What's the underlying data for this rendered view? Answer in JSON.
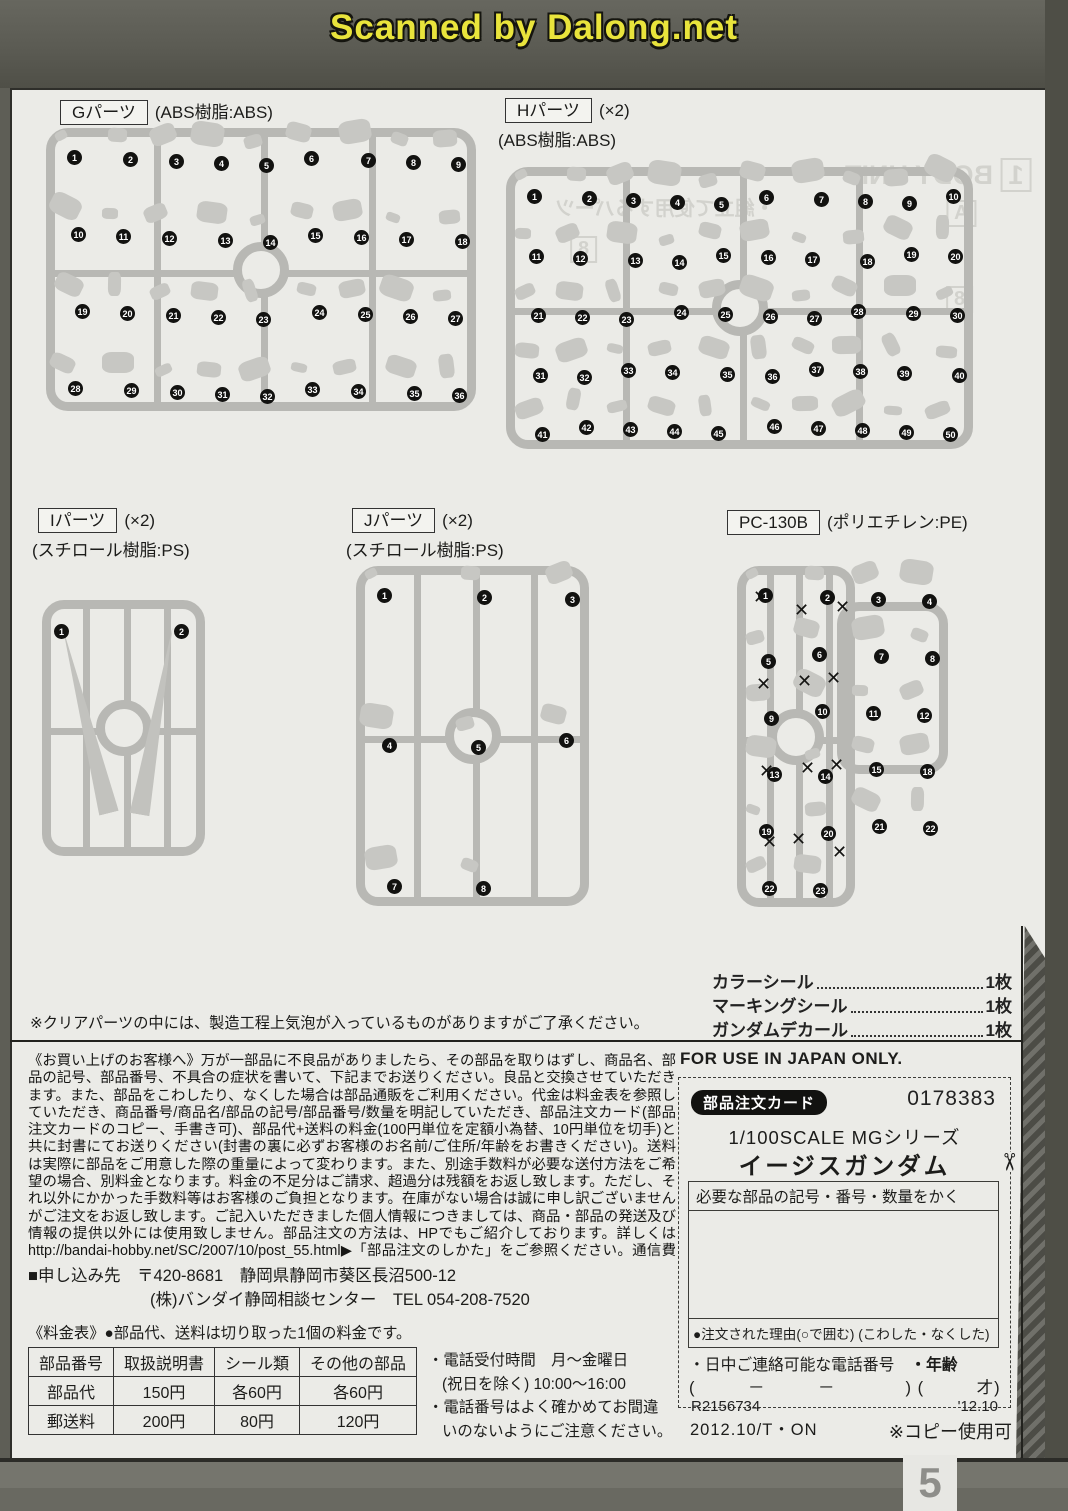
{
  "watermark": "Scanned by Dalong.net",
  "page_number": "5",
  "runners": [
    {
      "id": "G",
      "label": "Gパーツ",
      "qty": "",
      "material": "(ABS樹脂:ABS)",
      "numbers": [
        1,
        2,
        3,
        4,
        5,
        6,
        7,
        8,
        9,
        10,
        11,
        12,
        13,
        14,
        15,
        16,
        17,
        18,
        19,
        20,
        21,
        22,
        23,
        24,
        25,
        26,
        27,
        28,
        29,
        30,
        31,
        32,
        33,
        34,
        35,
        36
      ]
    },
    {
      "id": "H",
      "label": "Hパーツ",
      "qty": "(×2)",
      "material": "(ABS樹脂:ABS)",
      "numbers": [
        1,
        2,
        3,
        4,
        5,
        6,
        7,
        8,
        9,
        10,
        11,
        12,
        13,
        14,
        15,
        16,
        17,
        18,
        19,
        20,
        21,
        22,
        23,
        24,
        25,
        26,
        27,
        28,
        29,
        30,
        31,
        32,
        33,
        34,
        35,
        36,
        37,
        38,
        39,
        40,
        41,
        42,
        43,
        44,
        45,
        46,
        47,
        48,
        49,
        50
      ]
    },
    {
      "id": "I",
      "label": "Iパーツ",
      "qty": "(×2)",
      "material": "(スチロール樹脂:PS)",
      "numbers": [
        1,
        2
      ]
    },
    {
      "id": "J",
      "label": "Jパーツ",
      "qty": "(×2)",
      "material": "(スチロール樹脂:PS)",
      "numbers": [
        1,
        2,
        3,
        4,
        5,
        6,
        7,
        8
      ]
    },
    {
      "id": "PC",
      "label": "PC-130B",
      "qty": "",
      "material": "(ポリエチレン:PE)",
      "numbers": [
        1,
        2,
        3,
        4,
        5,
        6,
        7,
        8,
        9,
        10,
        11,
        12,
        13,
        14,
        15,
        18,
        19,
        20,
        21,
        22,
        22,
        23
      ],
      "x_count": 12
    }
  ],
  "stickers": [
    {
      "name": "カラーシール",
      "count": "1枚"
    },
    {
      "name": "マーキングシール",
      "count": "1枚"
    },
    {
      "name": "ガンダムデカール",
      "count": "1枚"
    }
  ],
  "clear_parts_note": "※クリアパーツの中には、製造工程上気泡が入っているものがありますがご了承ください。",
  "customer_notice": {
    "body": "《お買い上げのお客様へ》万が一部品に不良品がありましたら、その部品を取りはずし、商品名、部品の記号、部品番号、不具合の症状を書いて、下記までお送りください。良品と交換させていただきます。また、部品をこわしたり、なくした場合は部品通販をご利用ください。代金は料金表を参照していただき、商品番号/商品名/部品の記号/部品番号/数量を明記していただき、部品注文カード(部品注文カードのコピー、手書き可)、部品代+送料の料金(100円単位を定額小為替、10円単位を切手)と共に封書にてお送りください(封書の裏に必ずお客様のお名前/ご住所/年齢をお書きください)。送料は実際に部品をご用意した際の重量によって変わります。また、別途手数料が必要な送付方法をご希望の場合、別料金となります。料金の不足分はご請求、超過分は残額をお返し致します。ただし、それ以外にかかった手数料等はお客様のご負担となります。在庫がない場合は誠に申し訳ございませんがご注文をお返し致します。ご記入いただきました個人情報につきましては、商品・部品の発送及び情報の提供以外には使用致しません。部品注文の方法は、HPでもご紹介しております。詳しくはhttp://bandai-hobby.net/SC/2007/10/post_55.html▶「部品注文のしかた」をご参照ください。通信費等はお客様のご負担となります。",
    "bold_warning": "※お送りした部品に不良がある場合を除き、お客様都合での注文内容の変更、キャンセル、交換、返品は受付けておりませんので予めご了承ください。"
  },
  "application": {
    "label": "■申し込み先",
    "line1": "〒420-8681　静岡県静岡市葵区長沼500-12",
    "line2": "(株)バンダイ静岡相談センター　TEL 054-208-7520"
  },
  "price_table": {
    "title": "《料金表》●部品代、送料は切り取った1個の料金です。",
    "headers": [
      "部品番号",
      "取扱説明書",
      "シール類",
      "その他の部品"
    ],
    "rows": [
      [
        "部品代",
        "150円",
        "各60円",
        "各60円"
      ],
      [
        "郵送料",
        "200円",
        "80円",
        "120円"
      ]
    ]
  },
  "phone_notes": [
    "・電話受付時間　月〜金曜日",
    "(祝日を除く) 10:00〜16:00",
    "・電話番号はよく確かめてお間違",
    "いのないようにご注意ください。"
  ],
  "order_card": {
    "japan_only": "FOR USE IN JAPAN ONLY.",
    "card_label": "部品注文カード",
    "card_number": "0178383",
    "series": "1/100SCALE MGシリーズ",
    "product": "イージスガンダム",
    "fill_instruction": "必要な部品の記号・番号・数量をかく",
    "reason_line": "●注文された理由(○で囲む) (こわした・なくした)",
    "phone_label": "・日中ご連絡可能な電話番号",
    "age_label": "・年齢",
    "phone_blank": "(　　　－　　　－　　　　)",
    "age_blank": "(　　　才)",
    "code": "R2156734",
    "date": "'12.10",
    "print_code": "2012.10/T・ON",
    "copy_ok": "※コピー使用可"
  },
  "bleedthrough": {
    "body_unit": "BODY UNIT",
    "unit_no": "1",
    "tab_a": "A",
    "tab_8": "8",
    "jp_line": "・組立て使用するパーツ"
  }
}
